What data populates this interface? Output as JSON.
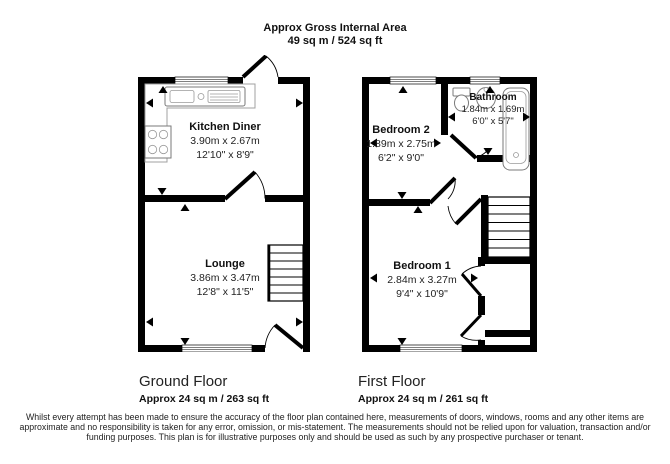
{
  "header": {
    "title": "Approx Gross Internal Area",
    "value": "49 sq m / 524 sq ft"
  },
  "ground_floor": {
    "title": "Ground Floor",
    "area": "Approx 24 sq m / 263 sq ft",
    "rooms": {
      "kitchen_diner": {
        "name": "Kitchen Diner",
        "metric": "3.90m x 2.67m",
        "imperial": "12'10\" x 8'9\""
      },
      "lounge": {
        "name": "Lounge",
        "metric": "3.86m x 3.47m",
        "imperial": "12'8\" x 11'5\""
      }
    }
  },
  "first_floor": {
    "title": "First Floor",
    "area": "Approx 24 sq m / 261 sq ft",
    "rooms": {
      "bedroom_2": {
        "name": "Bedroom 2",
        "metric": "1.89m x 2.75m",
        "imperial": "6'2\" x 9'0\""
      },
      "bathroom": {
        "name": "Bathroom",
        "metric": "1.84m x 1.69m",
        "imperial": "6'0\" x 5'7\""
      },
      "bedroom_1": {
        "name": "Bedroom 1",
        "metric": "2.84m x 3.27m",
        "imperial": "9'4\" x 10'9\""
      }
    }
  },
  "colors": {
    "wall": "#000000",
    "fixture_outline": "#7a7a7a",
    "background": "#ffffff"
  },
  "disclaimer": "Whilst every attempt has been made to ensure the accuracy of the floor plan contained here, measurements of doors, windows, rooms and any other items are approximate and no responsibility is taken for any error, omission, or mis-statement. The measurements should not be relied upon for valuation, transaction and/or funding purposes. This plan is for illustrative purposes only and should be used as such by any prospective purchaser or tenant."
}
